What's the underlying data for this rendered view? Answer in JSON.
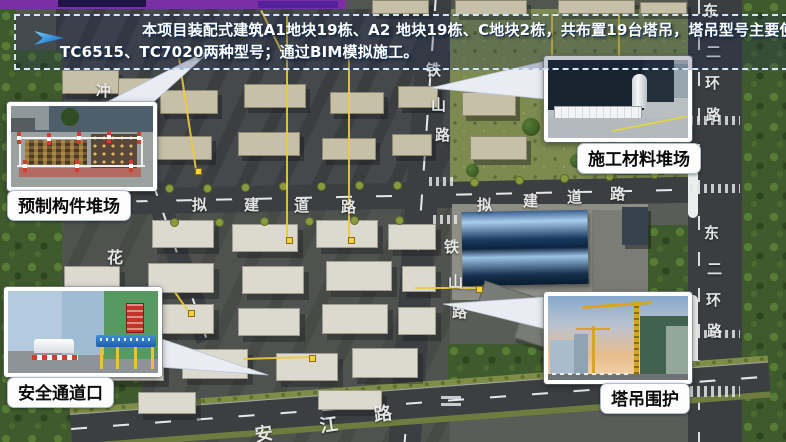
{
  "banner": {
    "line1": "本项目装配式建筑A1地块19栋、A2 地块19栋、C地块2栋，共布置19台塔吊，塔吊型号主要使用",
    "line2": "TC6515、TC7020两种型号；通过BIM模拟施工。",
    "icon": "blue-arrow"
  },
  "callouts": {
    "precast": {
      "label": "预制构件堆场"
    },
    "materials": {
      "label": "施工材料堆场"
    },
    "safety": {
      "label": "安全通道口"
    },
    "crane": {
      "label": "塔吊围护"
    }
  },
  "roads": {
    "tieshan": "铁山路",
    "planned": "拟建道路",
    "ring": "东二环路",
    "hua": "花",
    "chong": "冲",
    "jiang": "安江路"
  },
  "colors": {
    "banner_border": "#d5e8fa",
    "banner_text": "#ffffff",
    "arrow_blue": "#2b9fe8",
    "top_bar_purple": "#7b2fa4",
    "label_text": "#0a0a0a",
    "yellow_line": "#edc93f"
  }
}
